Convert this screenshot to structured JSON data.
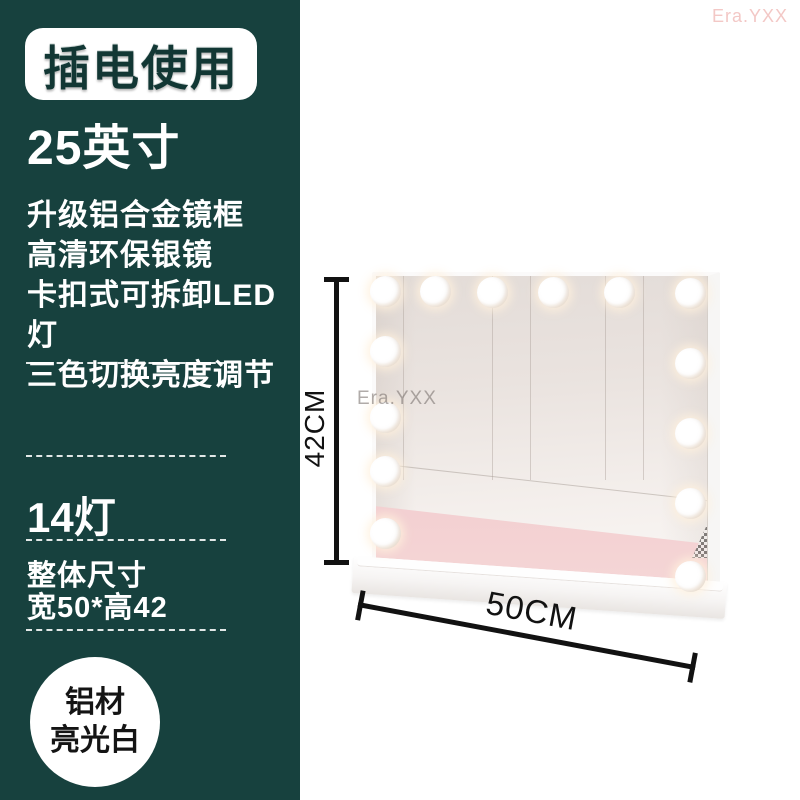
{
  "watermarks": {
    "top_right": "Era.YXX",
    "mirror": "Era.YXX"
  },
  "panel": {
    "badge_label": "插电使用",
    "size_title": "25英寸",
    "features": [
      "升级铝合金镜框",
      "高清环保银镜",
      "卡扣式可拆卸LED灯",
      "三色切换亮度调节"
    ],
    "lights_label": "14灯",
    "dimensions_title": "整体尺寸",
    "dimensions_value": "宽50*高42",
    "material_line1": "铝材",
    "material_line2": "亮光白"
  },
  "dimension_labels": {
    "height": "42CM",
    "width": "50CM"
  },
  "bulb_count": 14,
  "colors": {
    "panel_bg": "#17413e",
    "badge_text": "#123734",
    "pink_band": "#efc5ca",
    "watermark_pink": "#f3c8c6",
    "annotation": "#121212"
  }
}
